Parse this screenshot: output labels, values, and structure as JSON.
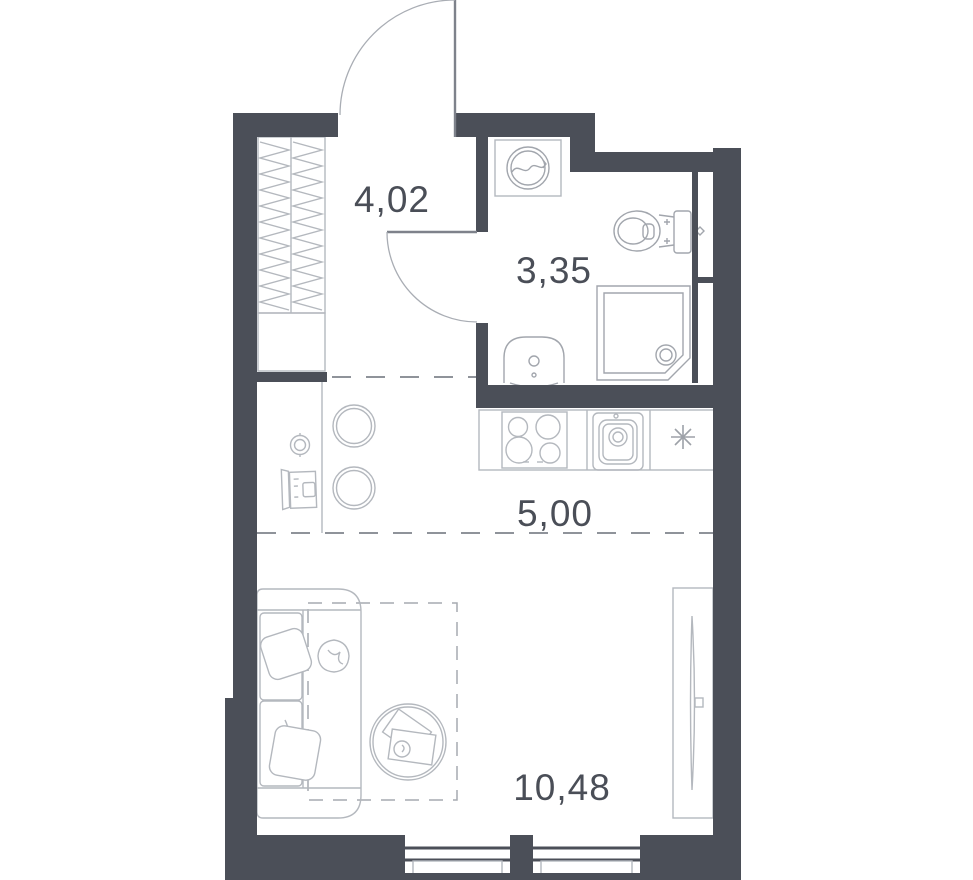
{
  "title": "Studio apartment floor plan",
  "rooms": [
    {
      "name": "hallway",
      "area": "4,02"
    },
    {
      "name": "bathroom",
      "area": "3,35"
    },
    {
      "name": "kitchen",
      "area": "5,00"
    },
    {
      "name": "living-room",
      "area": "10,48"
    }
  ],
  "colors": {
    "wall": "#4b4f58",
    "furniture_line": "#b4b8be",
    "fixture_line": "#a2a6ad",
    "dash_line": "#8f939a",
    "label": "#4a4e57",
    "background": "#ffffff"
  },
  "fixtures": {
    "hallway": [
      "entrance-door",
      "wardrobe-hatched",
      "cabinet"
    ],
    "bathroom": [
      "washing-machine",
      "toilet",
      "shower",
      "wash-basin",
      "bath-door",
      "duct-niche"
    ],
    "kitchen": [
      "counter",
      "stove-4-burners",
      "kitchen-sink",
      "fridge-asterisk",
      "stool",
      "stool",
      "tv-stand",
      "wall-light"
    ],
    "living_room": [
      "sofa",
      "pillow",
      "pillow",
      "plant",
      "coffee-table",
      "rug-dashed",
      "tv-unit"
    ],
    "windows": 2
  }
}
